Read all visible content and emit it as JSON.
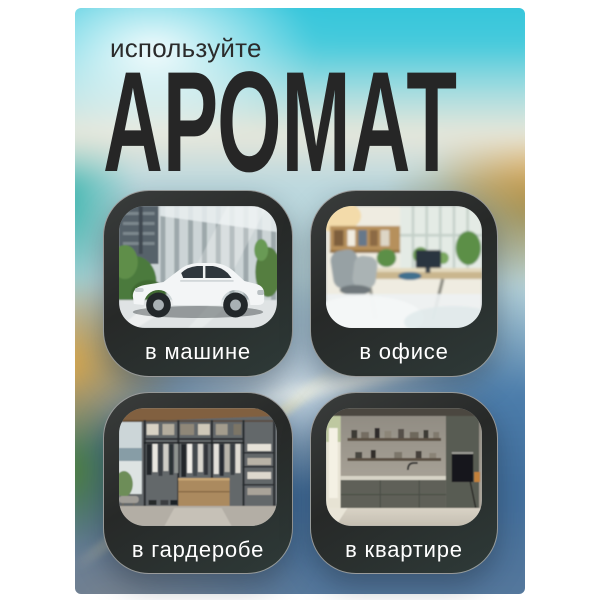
{
  "header": {
    "eyebrow": "используйте",
    "title": "АРОМАТ"
  },
  "cards": [
    {
      "id": "car",
      "label": "в машине",
      "image": "white-sedan-near-glass-building"
    },
    {
      "id": "office",
      "label": "в офисе",
      "image": "bright-open-office-with-plants"
    },
    {
      "id": "wardrobe",
      "label": "в гардеробе",
      "image": "walk-in-closet-with-clothes"
    },
    {
      "id": "apartment",
      "label": "в квартире",
      "image": "modern-kitchen-dark-cabinets"
    }
  ],
  "colors": {
    "page_bg": "#ffffff",
    "eyebrow_text": "#2b2b2b",
    "title_text": "#262626",
    "card_bg": "#2c2e2d",
    "card_border": "rgba(255,255,255,0.5)",
    "card_label": "#ffffff",
    "sky_cyan": "#2fc4db",
    "water_blue": "#4c7dab"
  }
}
